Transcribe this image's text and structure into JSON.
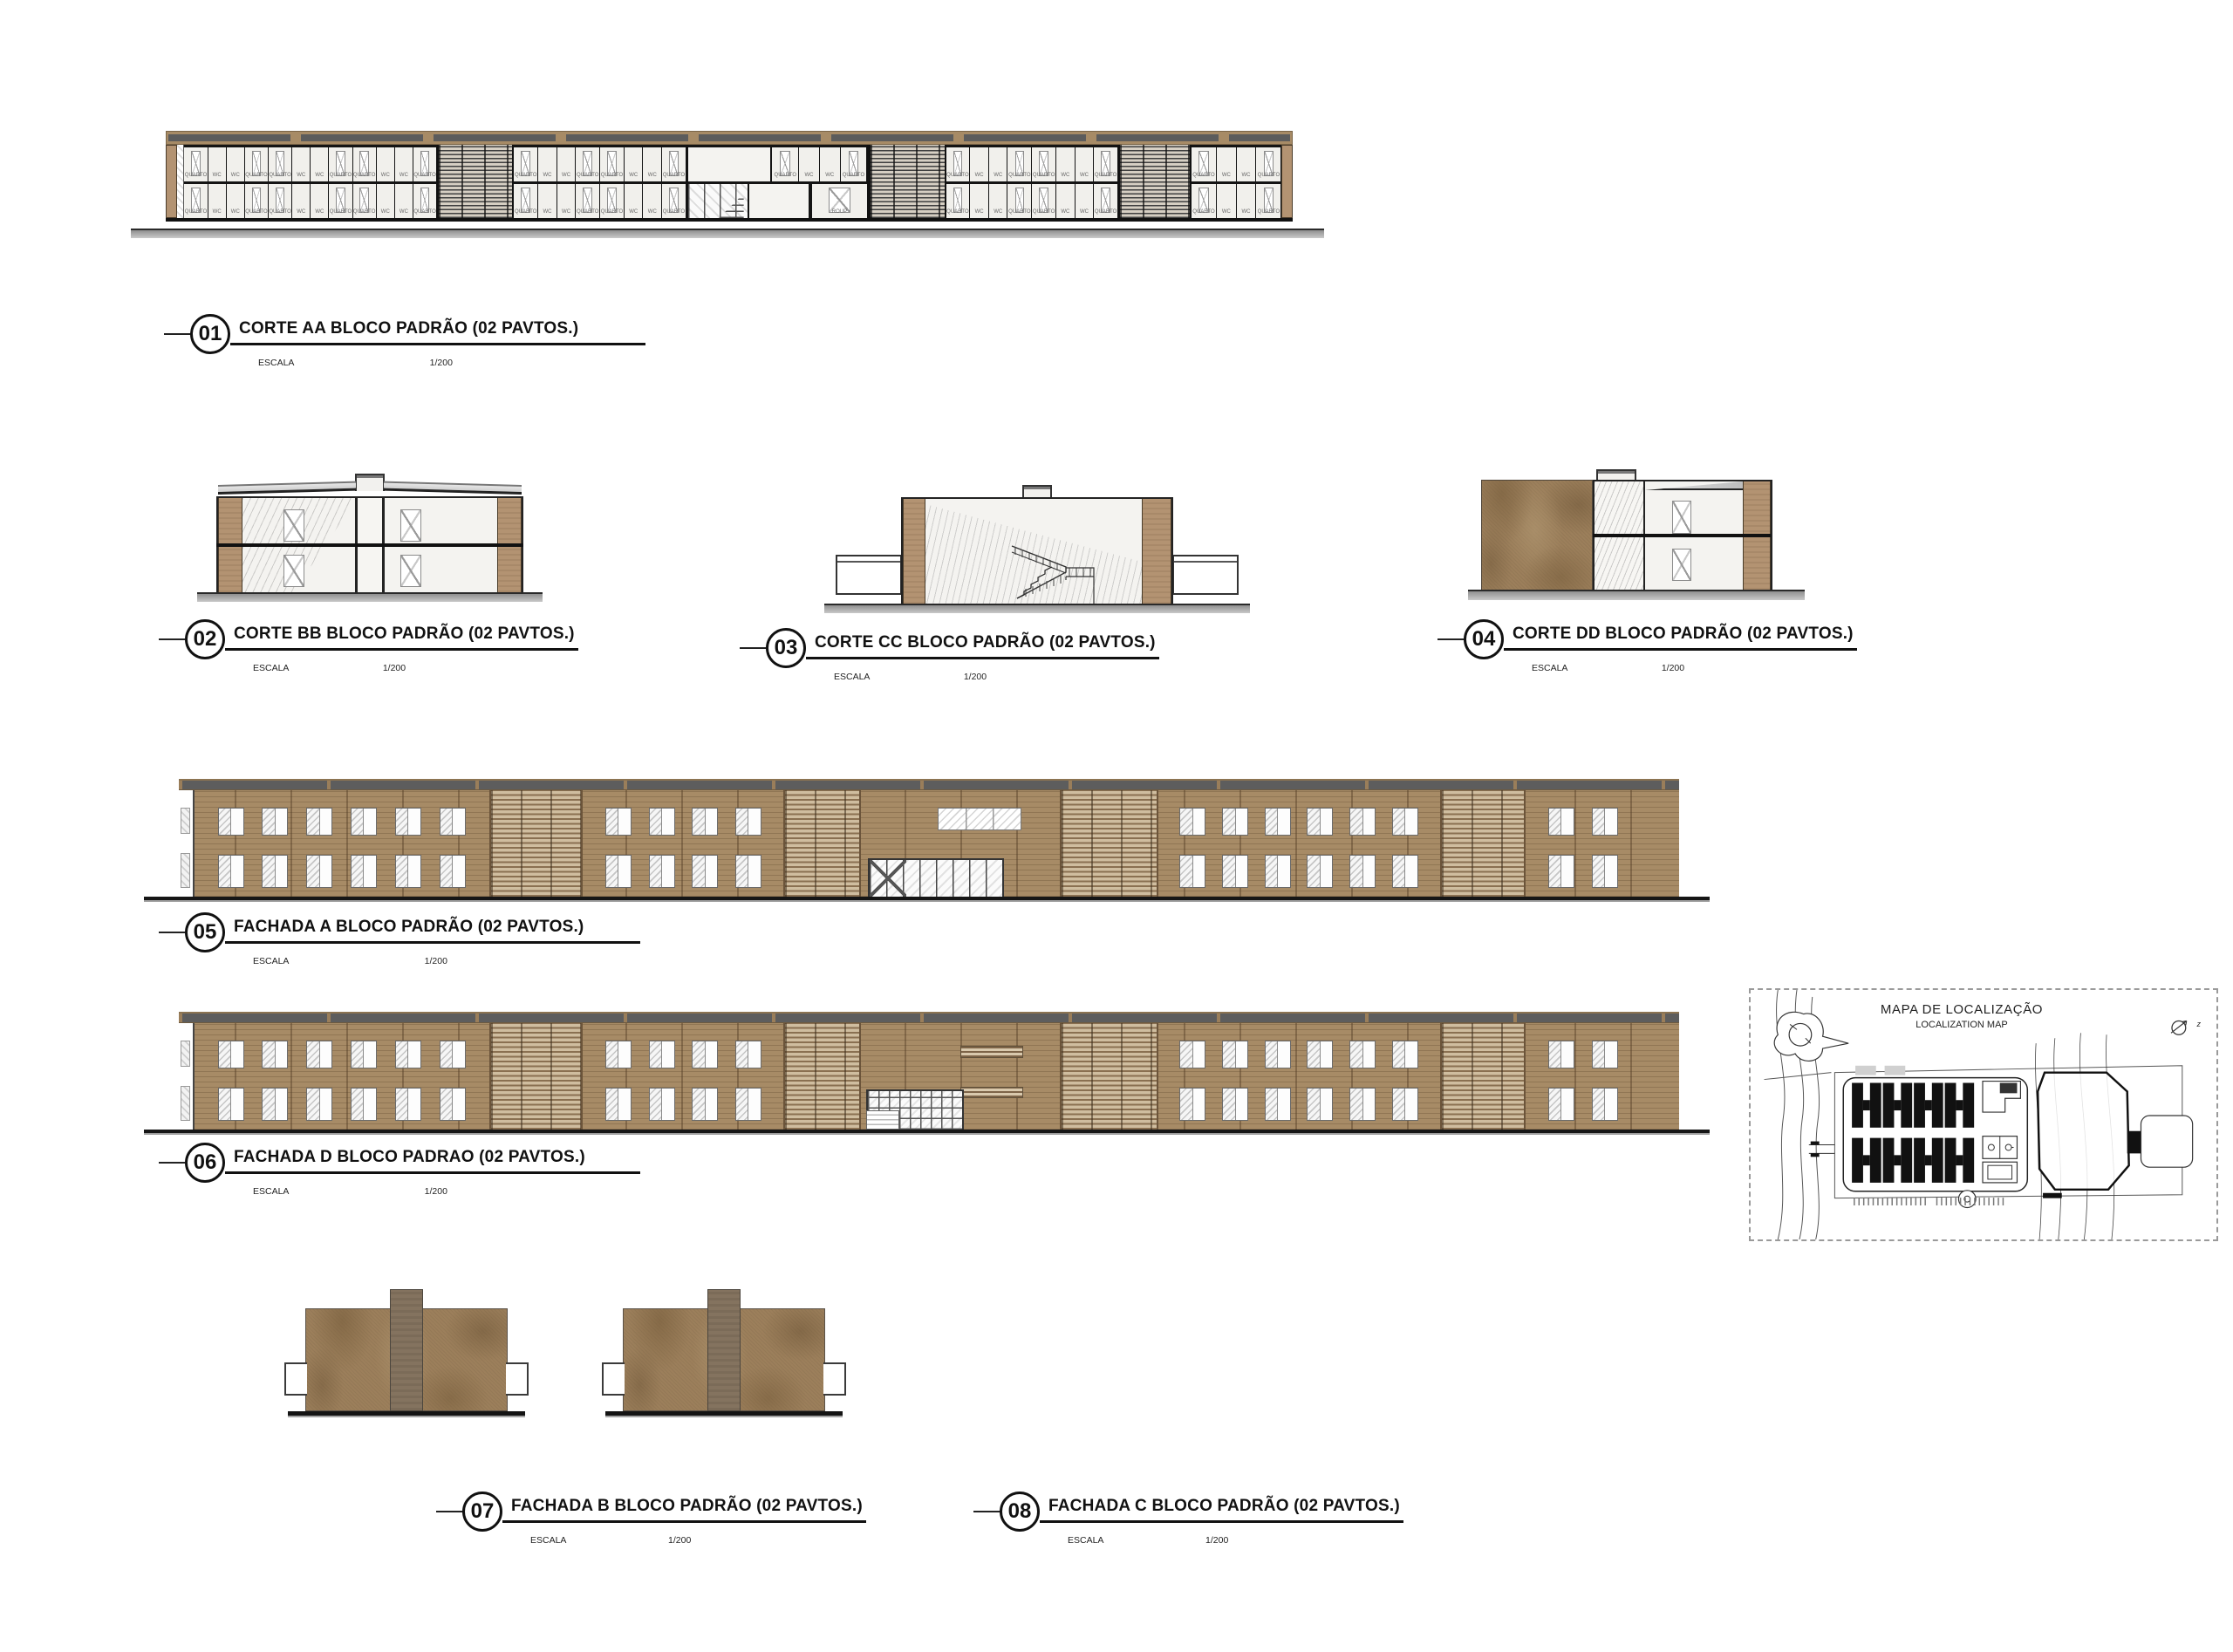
{
  "sheet": {
    "background": "#ffffff"
  },
  "labels": {
    "escala": "ESCALA",
    "scale": "1/200"
  },
  "drawings": [
    {
      "num": "01",
      "title": "CORTE AA BLOCO PADRÃO (02 PAVTOS.)"
    },
    {
      "num": "02",
      "title": "CORTE BB BLOCO PADRÃO (02 PAVTOS.)"
    },
    {
      "num": "03",
      "title": "CORTE CC BLOCO PADRÃO (02 PAVTOS.)"
    },
    {
      "num": "04",
      "title": "CORTE DD BLOCO PADRÃO (02 PAVTOS.)"
    },
    {
      "num": "05",
      "title": "FACHADA A BLOCO PADRÃO (02 PAVTOS.)"
    },
    {
      "num": "06",
      "title": "FACHADA D BLOCO PADRAO (02 PAVTOS.)"
    },
    {
      "num": "07",
      "title": "FACHADA B BLOCO PADRÃO (02 PAVTOS.)"
    },
    {
      "num": "08",
      "title": "FACHADA C BLOCO PADRÃO (02 PAVTOS.)"
    }
  ],
  "rooms": {
    "quarto": "QUARTO",
    "wc": "WC",
    "roup": "ROUP"
  },
  "corte_aa": {
    "floors": 2,
    "module_pattern": [
      "QUARTO",
      "WC",
      "WC",
      "QUARTO"
    ],
    "wing_modules": [
      3,
      2,
      2,
      1
    ],
    "center_rooms": [
      "QUARTO",
      "WC",
      "WC",
      "QUARTO"
    ],
    "roup_room": "ROUP"
  },
  "fachada_a": {
    "window_groups": [
      6,
      4,
      6,
      2
    ]
  },
  "fachada_d": {
    "window_groups": [
      6,
      4,
      6,
      2
    ]
  },
  "map": {
    "title": "MAPA DE LOCALIZAÇÃO",
    "subtitle": "LOCALIZATION MAP",
    "north": "z"
  },
  "colors": {
    "facade_brown": "#a78b66",
    "wall_tan": "#b39372",
    "texture_brown": "#9c7f5b",
    "roof_gray": "#5d5d5d",
    "ground_gray": "#b5b5b5",
    "line_black": "#141414"
  }
}
